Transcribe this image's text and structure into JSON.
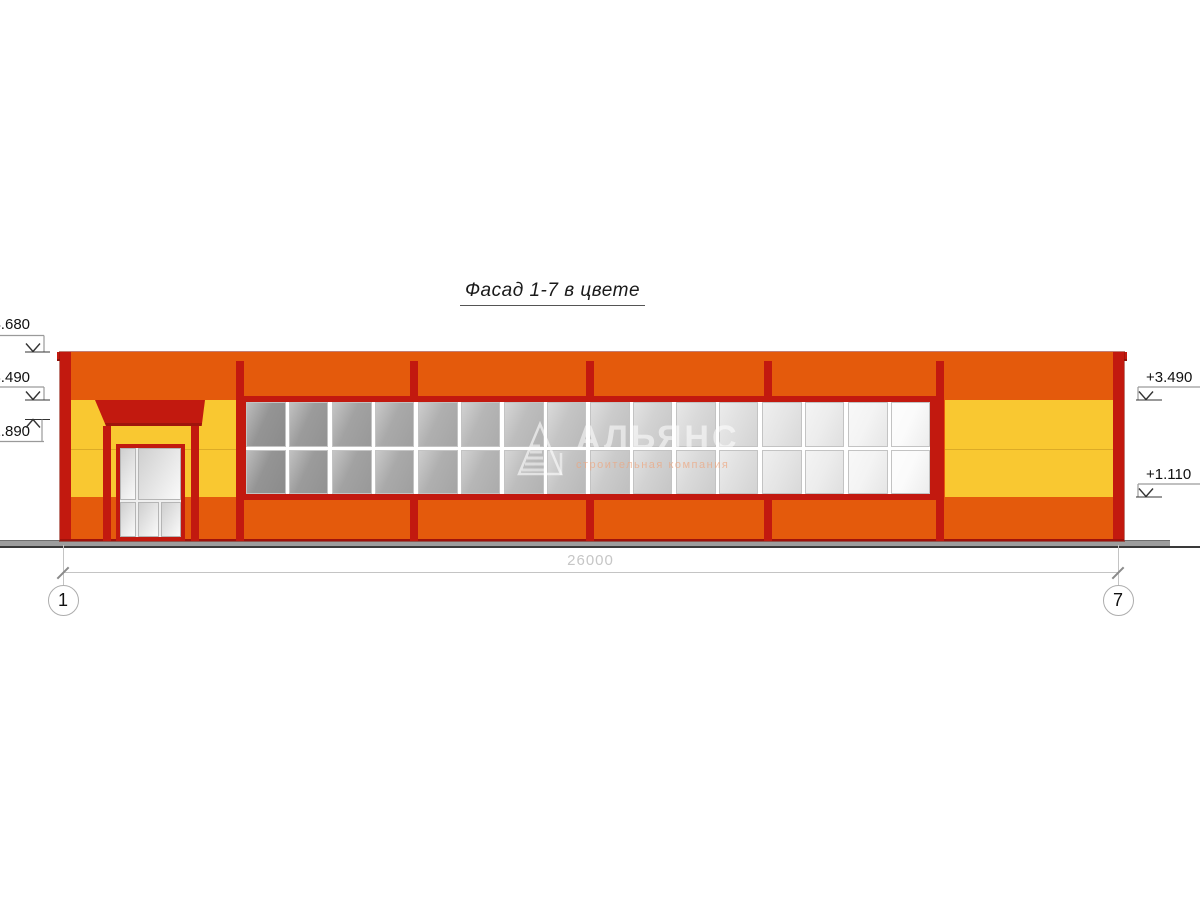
{
  "title": {
    "text": "Фасад 1-7 в цвете"
  },
  "watermark": {
    "company": "АЛЬЯНС",
    "tagline": "строительная компания"
  },
  "levels": {
    "left": [
      {
        "value": "+4.680"
      },
      {
        "value": "+3.490"
      },
      {
        "value": "+2.890"
      }
    ],
    "right": [
      {
        "value": "+3.490"
      },
      {
        "value": "+1.110"
      }
    ]
  },
  "dimension": {
    "total_width": "26000"
  },
  "axes": {
    "first": "1",
    "last": "7"
  },
  "windows": {
    "units": 8,
    "cols_per_unit": 2,
    "rows": 2,
    "glass_start": "#949494",
    "glass_end": "#FBFBFB"
  },
  "colors": {
    "facade_red": "#C2190F",
    "facade_orange": "#E45A0C",
    "facade_yellow": "#F9C831",
    "ground_gray": "#9D9D9D",
    "baseline_dark": "#3A3A3A",
    "annotation_gray": "#C4C4C4"
  }
}
